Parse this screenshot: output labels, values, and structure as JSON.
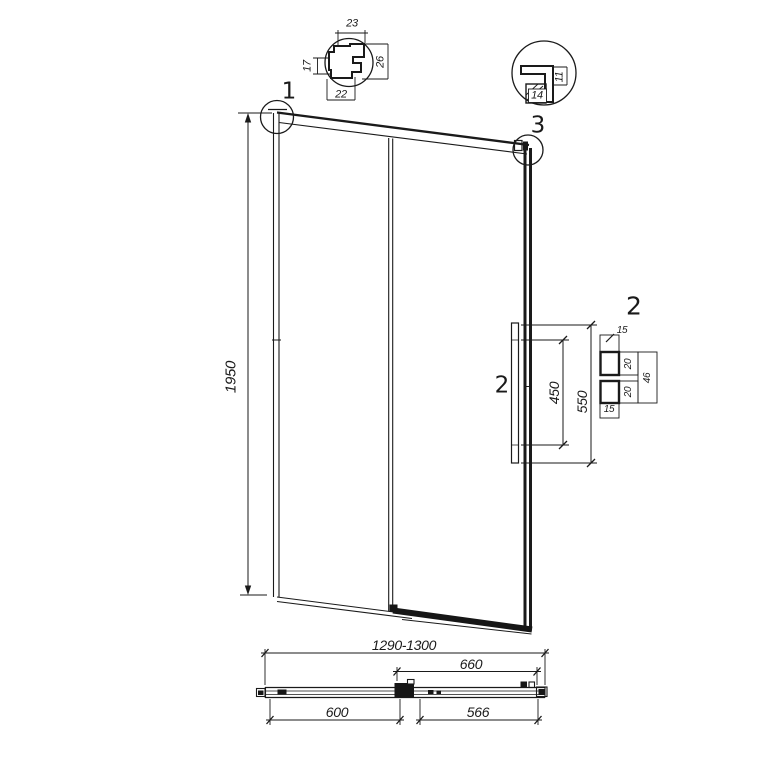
{
  "page": {
    "background": "#ffffff",
    "line_color": "#1a1a1a"
  },
  "callouts": {
    "one": "1",
    "two_handle": "2",
    "two_detail": "2",
    "three": "3"
  },
  "elevation": {
    "height": "1950",
    "handle_span": "450",
    "handle_length": "550"
  },
  "detail1": {
    "top": "23",
    "left": "17",
    "right": "26",
    "bottom": "22"
  },
  "detail3": {
    "right": "11",
    "bottom": "14"
  },
  "detail2": {
    "top": "15",
    "upper": "20",
    "lower": "20",
    "total": "46",
    "bottom": "15"
  },
  "plan": {
    "overall": "1290-1300",
    "door": "660",
    "fixed": "600",
    "opening": "566"
  }
}
